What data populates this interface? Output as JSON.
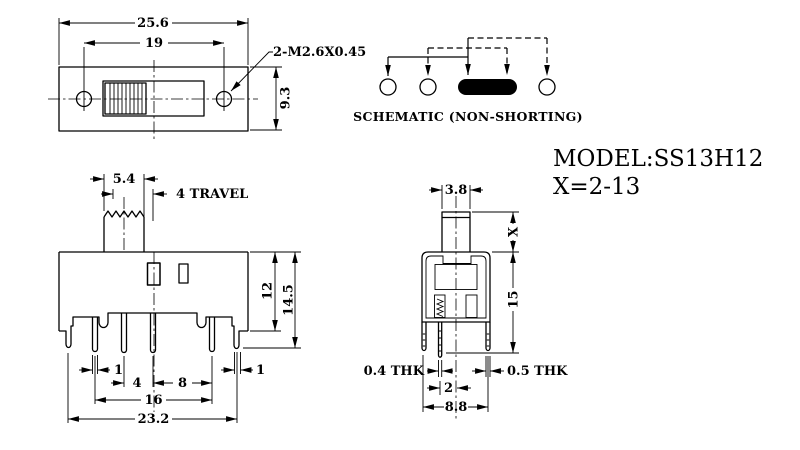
{
  "title": {
    "model": "MODEL:SS13H12",
    "x_range": "X=2-13"
  },
  "schematic": {
    "caption": "SCHEMATIC (NON-SHORTING)"
  },
  "top_view": {
    "overall_width": "25.6",
    "hole_spacing": "19",
    "height": "9.3",
    "thread_callout": "2-M2.6X0.45"
  },
  "front_view": {
    "knob_width": "5.4",
    "travel": "4 TRAVEL",
    "height_to_base": "12",
    "height_to_leg": "14.5",
    "pin_width": "1",
    "pitch_small": "4",
    "pitch_large": "8",
    "leg_width": "1",
    "pin_span": "16",
    "overall_width": "23.2"
  },
  "side_view": {
    "knob_depth": "3.8",
    "actuator_height": "X",
    "height": "15",
    "pin_thickness": "0.4 THK",
    "leg_thickness": "0.5 THK",
    "pin_to_center": "2",
    "leg_span": "8.8"
  }
}
